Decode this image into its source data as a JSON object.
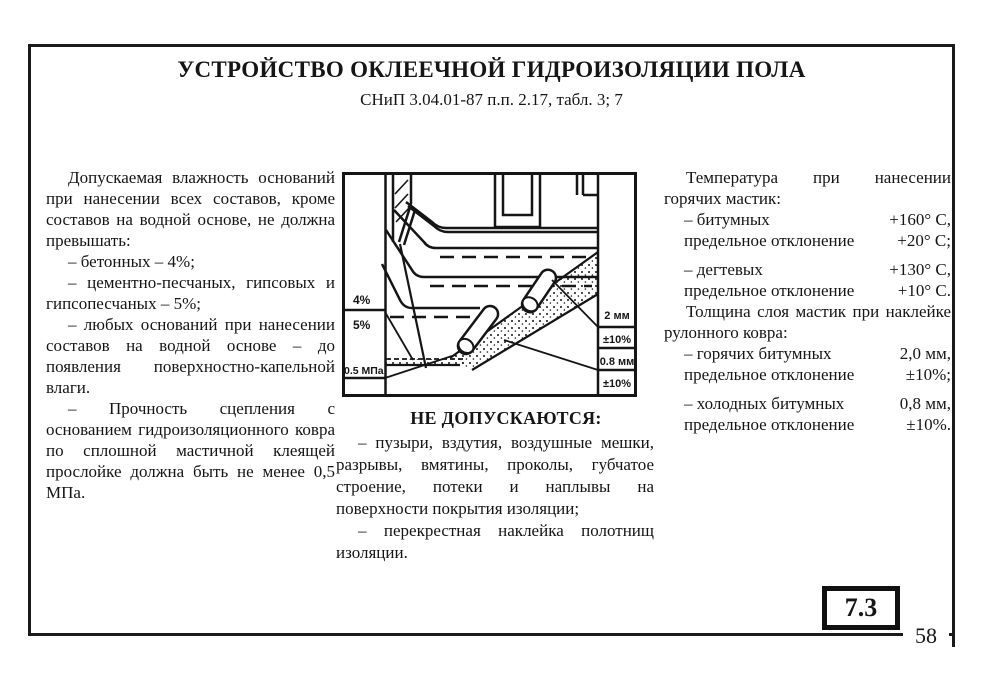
{
  "page": {
    "title": "УСТРОЙСТВО ОКЛЕЕЧНОЙ ГИДРОИЗОЛЯЦИИ ПОЛА",
    "subtitle": "СНиП 3.04.01-87 п.п. 2.17, табл. 3; 7",
    "section_number": "7.3",
    "page_number": "58"
  },
  "left_column": {
    "paragraphs": [
      "Допускаемая влажность оснований при нанесении всех составов, кроме составов на водной основе, не должна превышать:",
      "– бетонных – 4%;",
      "– цементно-песчаных, гипсовых и гипсопесчаных – 5%;",
      "– любых оснований при нанесении составов на водной основе – до появления поверхностно-капельной влаги.",
      "– Прочность сцепления с основанием гидроизоляционного ковра по сплошной мастичной клеящей прослойке должна быть не менее 0,5 МПа."
    ]
  },
  "diagram": {
    "left_labels": [
      "4%",
      "5%",
      "0.5 МПа"
    ],
    "right_labels": [
      "2 мм",
      "±10%",
      "0.8 мм",
      "±10%"
    ]
  },
  "notes": {
    "heading": "НЕ ДОПУСКАЮТСЯ:",
    "items": [
      "– пузыри, вздутия, воздушные мешки, разрывы, вмятины, проколы, губчатое строение, потеки и наплывы на поверхности покрытия изоляции;",
      "– перекрестная наклейка полотнищ изоляции."
    ]
  },
  "right_column": {
    "temp_heading": "Температура при нанесении горячих мастик:",
    "temp_rows": [
      {
        "label": "– битумных",
        "value": "+160° С,"
      },
      {
        "label": "предельное отклонение",
        "value": "+20° С;"
      },
      {
        "label": "– дегтевых",
        "value": "+130° С,"
      },
      {
        "label": "предельное отклонение",
        "value": "+10° С."
      }
    ],
    "thickness_heading": "Толщина слоя мастик при наклейке рулонного ковра:",
    "thickness_rows": [
      {
        "label": "– горячих битумных",
        "value": "2,0 мм,"
      },
      {
        "label": "предельное отклонение",
        "value": "±10%;"
      },
      {
        "label": "– холодных битумных",
        "value": "0,8 мм,"
      },
      {
        "label": "предельное отклонение",
        "value": "±10%."
      }
    ]
  }
}
